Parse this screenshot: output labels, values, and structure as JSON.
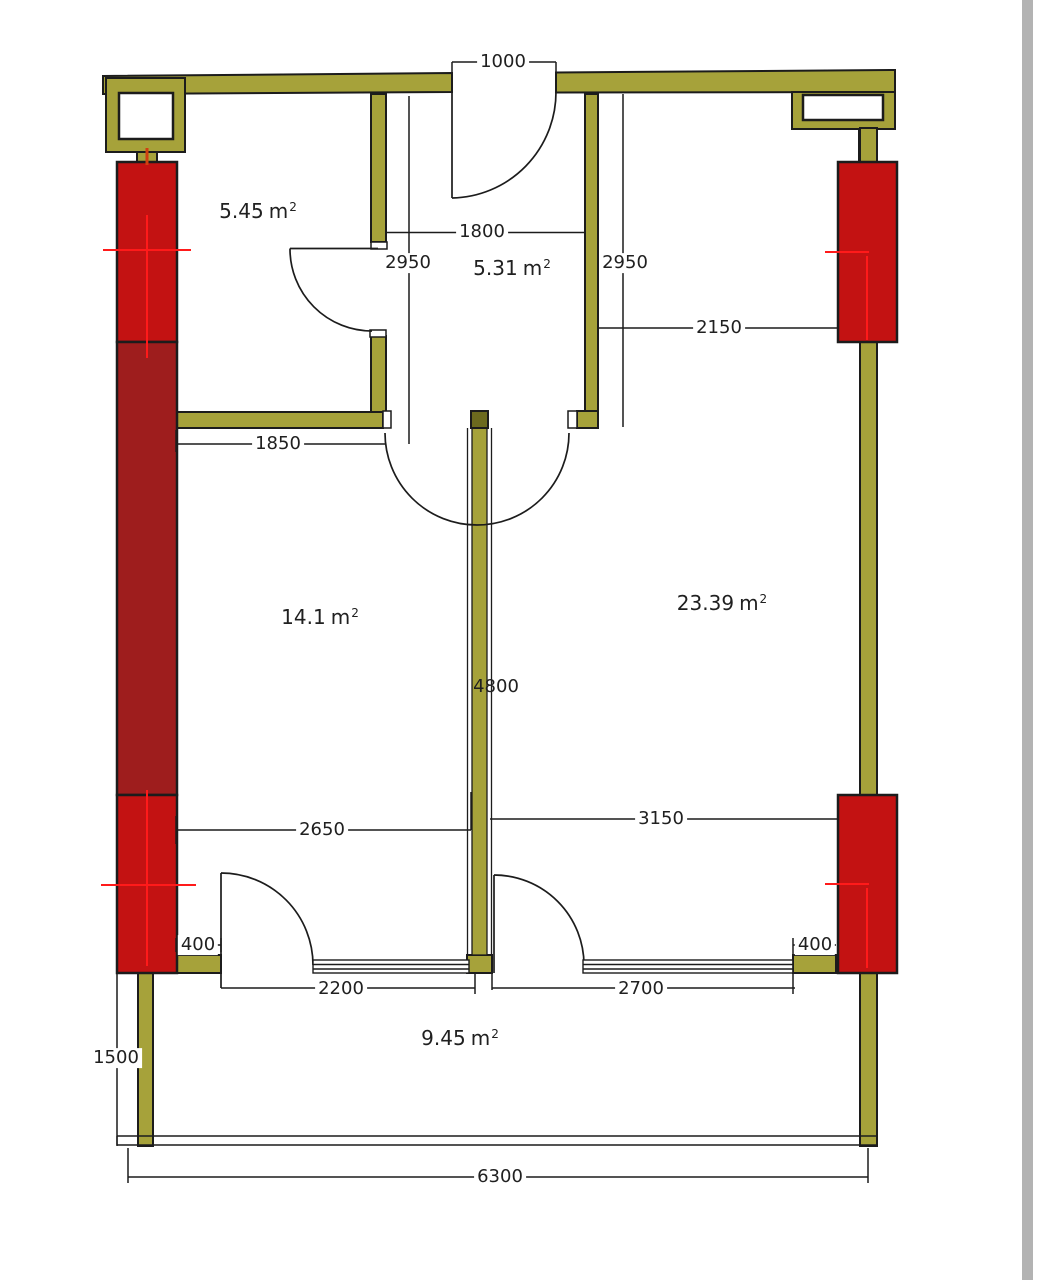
{
  "colors": {
    "wall": "#a6a23a",
    "wall_dark_cap": "#6c6a1e",
    "column_red": "#c31212",
    "column_dark_red": "#9e1d1d",
    "centerline_red": "#ff1a1a",
    "stub_centerline": "#d04010",
    "line": "#1c1c1c",
    "page_edge": "#b3b3b3",
    "background": "#ffffff"
  },
  "rooms": [
    {
      "name": "room-top-left",
      "value": "5.45",
      "unit_base": "m",
      "unit_exp": "2"
    },
    {
      "name": "hall-top-center",
      "value": "5.31",
      "unit_base": "m",
      "unit_exp": "2"
    },
    {
      "name": "room-left",
      "value": "14.1",
      "unit_base": "m",
      "unit_exp": "2"
    },
    {
      "name": "room-right",
      "value": "23.39",
      "unit_base": "m",
      "unit_exp": "2"
    },
    {
      "name": "balcony",
      "value": "9.45",
      "unit_base": "m",
      "unit_exp": "2"
    }
  ],
  "dimensions": [
    {
      "name": "entrance-door-width",
      "label": "1000"
    },
    {
      "name": "hall-width",
      "label": "1800"
    },
    {
      "name": "hall-depth-left",
      "label": "2950"
    },
    {
      "name": "hall-depth-right",
      "label": "2950"
    },
    {
      "name": "room-right-top-offset",
      "label": "2150"
    },
    {
      "name": "room-top-left-bottom",
      "label": "1850"
    },
    {
      "name": "partition-length",
      "label": "4800"
    },
    {
      "name": "room-left-bottom-width",
      "label": "2650"
    },
    {
      "name": "room-right-bottom-width",
      "label": "3150"
    },
    {
      "name": "pier-left",
      "label": "400"
    },
    {
      "name": "pier-right",
      "label": "400"
    },
    {
      "name": "balcony-opening-left",
      "label": "2200"
    },
    {
      "name": "balcony-opening-right",
      "label": "2700"
    },
    {
      "name": "balcony-depth",
      "label": "1500"
    },
    {
      "name": "balcony-width",
      "label": "6300"
    }
  ]
}
